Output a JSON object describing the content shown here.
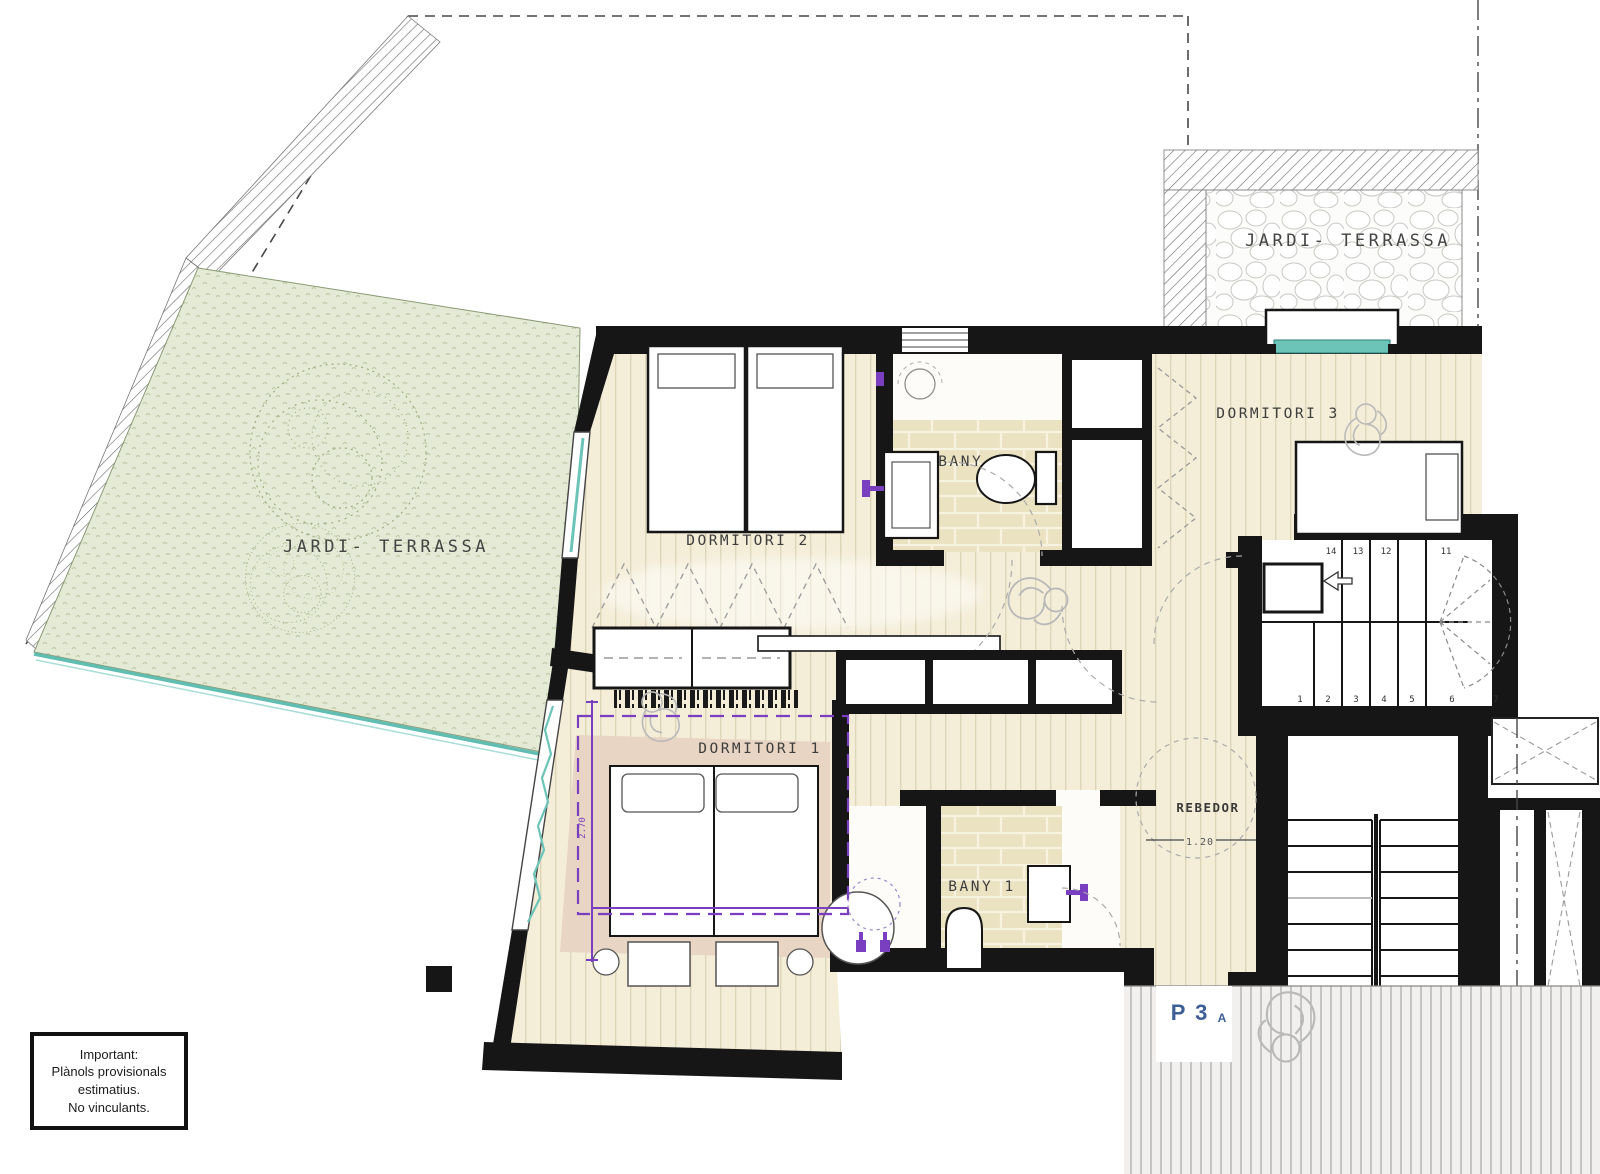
{
  "note_box": {
    "lines": [
      "Important:",
      "Plànols provisionals",
      "estimatius.",
      "No vinculants."
    ]
  },
  "labels": {
    "garden_left": "JARDI- TERRASSA",
    "garden_right": "JARDI- TERRASSA",
    "bedroom2": "DORMITORI 2",
    "bedroom3": "DORMITORI 3",
    "bedroom1": "DORMITORI 1",
    "bathroom2": "BANY 2",
    "bathroom1": "BANY 1",
    "hall": "REBEDOR",
    "floor_main": "P 3",
    "floor_sub": "A"
  },
  "dimensions": {
    "hall_clearance": "1.20",
    "bedroom1_width": "2.70"
  },
  "stairs": {
    "upper_numbers": [
      "14",
      "13",
      "12",
      "11"
    ],
    "lower_numbers": [
      "1",
      "2",
      "3",
      "4",
      "5",
      "6",
      "7"
    ]
  },
  "colors": {
    "wall": "#161616",
    "floor": "#f4eed9",
    "tile": "#ebe2c2",
    "rug": "#e8d5c3",
    "garden": "#e4ead5",
    "teal": "#6cc4b9",
    "purple": "#7a3fc1",
    "label_blue": "#3d5e97"
  }
}
